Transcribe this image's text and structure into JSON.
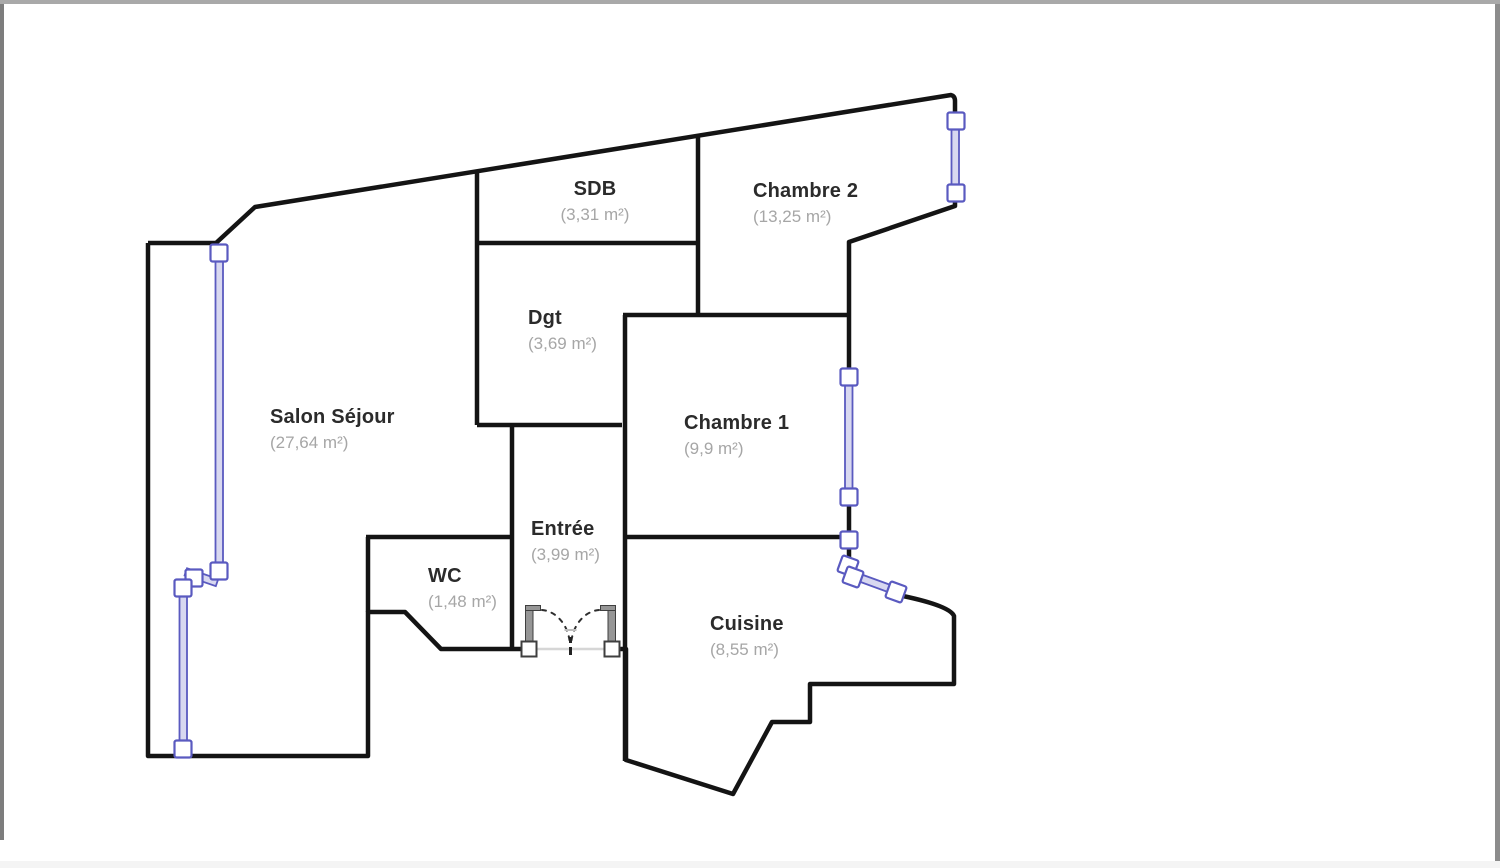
{
  "plan": {
    "type": "apartment-floor-plan",
    "rooms": [
      {
        "name": "SDB",
        "area": "(3,31 m²)"
      },
      {
        "name": "Chambre 2",
        "area": "(13,25 m²)"
      },
      {
        "name": "Dgt",
        "area": "(3,69 m²)"
      },
      {
        "name": "Salon Séjour",
        "area": "(27,64 m²)"
      },
      {
        "name": "Chambre 1",
        "area": "(9,9 m²)"
      },
      {
        "name": "Entrée",
        "area": "(3,99 m²)"
      },
      {
        "name": "WC",
        "area": "(1,48 m²)"
      },
      {
        "name": "Cuisine",
        "area": "(8,55 m²)"
      }
    ],
    "colors": {
      "wall": "#141414",
      "window_stroke": "#5a5ac0",
      "window_glass": "#d8d8f0",
      "door_leaf": "#969696",
      "door_swing": "#2e2e2e",
      "threshold": "#d6d6d6",
      "room_name_text": "#2b2b2b",
      "room_area_text": "#a6a6a6",
      "background": "#ffffff"
    }
  }
}
